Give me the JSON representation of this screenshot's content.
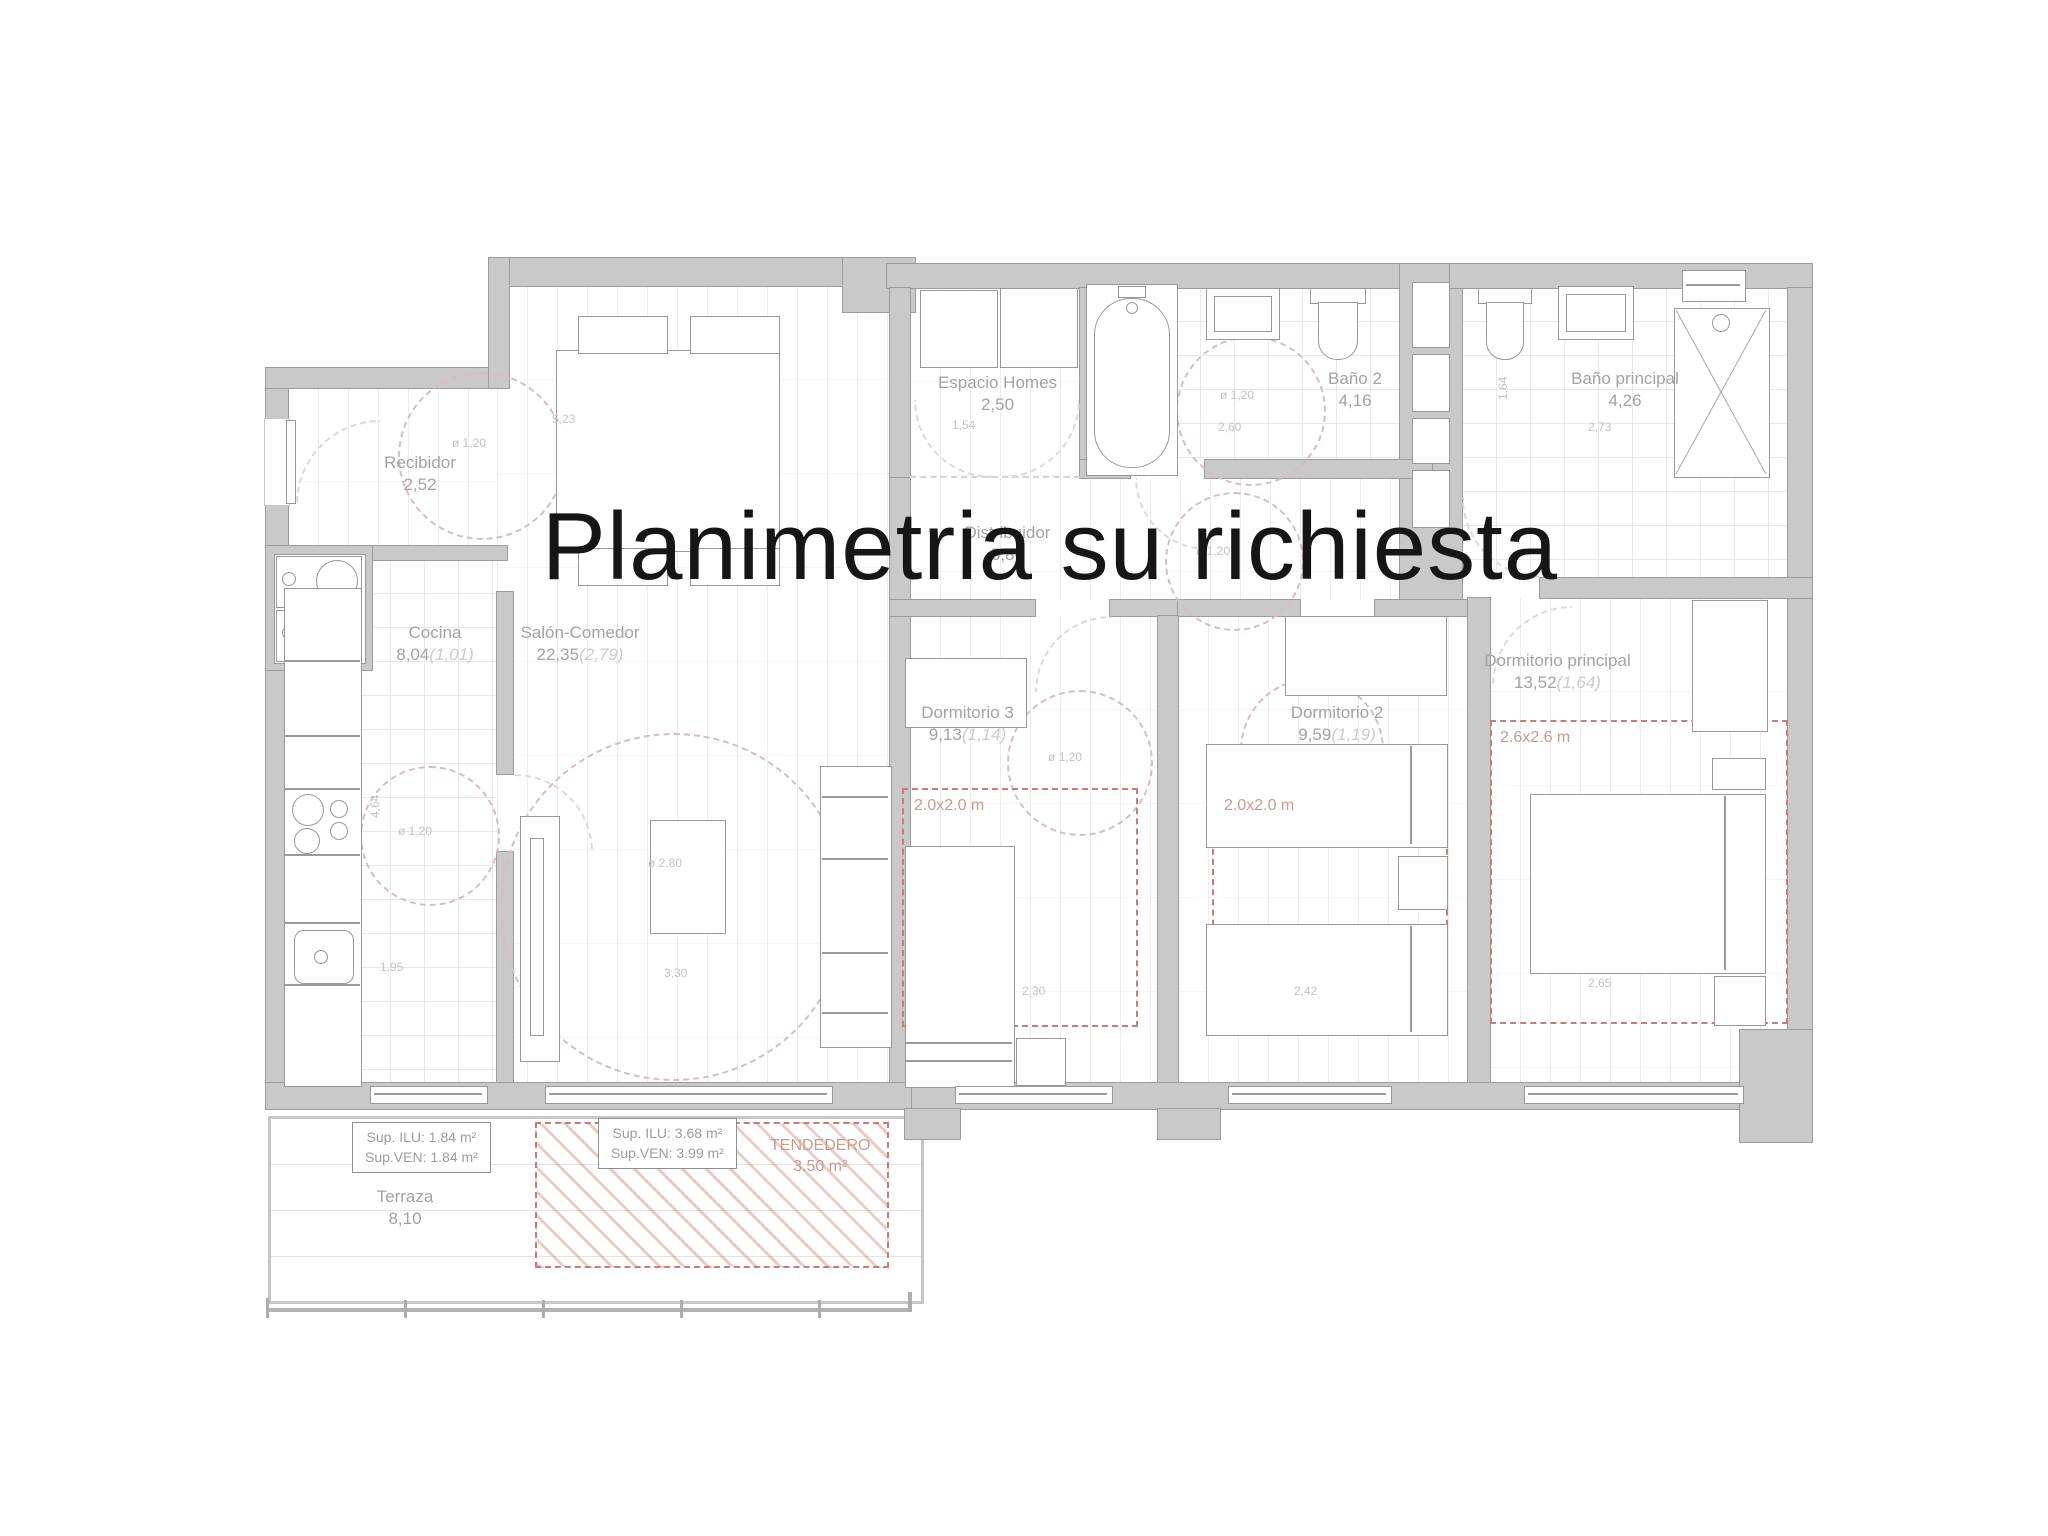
{
  "title": "Planimetria su richiesta",
  "rooms": {
    "recibidor": {
      "name": "Recibidor",
      "area": "2,52"
    },
    "cocina": {
      "name": "Cocina",
      "area": "8,04",
      "vent": "(1,01)"
    },
    "salon": {
      "name": "Salón-Comedor",
      "area": "22,35",
      "vent": "(2,79)"
    },
    "espacio_homes": {
      "name": "Espacio Homes",
      "area": "2,50"
    },
    "bano2": {
      "name": "Baño 2",
      "area": "4,16"
    },
    "bano_principal": {
      "name": "Baño principal",
      "area": "4,26"
    },
    "distribuidor": {
      "name": "Distribuidor",
      "area": "5,86"
    },
    "dormitorio3": {
      "name": "Dormitorio 3",
      "area": "9,13",
      "vent": "(1,14)"
    },
    "dormitorio2": {
      "name": "Dormitorio 2",
      "area": "9,59",
      "vent": "(1,19)"
    },
    "dormitorio_principal": {
      "name": "Dormitorio principal",
      "area": "13,52",
      "vent": "(1,64)"
    },
    "terraza": {
      "name": "Terraza",
      "area": "8,10"
    }
  },
  "annotations": {
    "sup_boxes": [
      {
        "ilu": "Sup. ILU:  1.84 m²",
        "ven": "Sup.VEN:  1.84 m²"
      },
      {
        "ilu": "Sup. ILU:  3.68 m²",
        "ven": "Sup.VEN:  3.99 m²"
      }
    ],
    "tendedero": {
      "name": "TENDEDERO",
      "area": "3.50 m²"
    },
    "clearance_squares": {
      "dorm3": "2.0x2.0 m",
      "dorm2": "2.0x2.0 m",
      "dormp": "2.6x2.6 m"
    }
  },
  "dimensions": {
    "salon_width": "5,23",
    "salon_circle": "ø 2,80",
    "salon_window": "3,30",
    "recibidor_circle": "ø 1,20",
    "cocina_circle": "ø 1,20",
    "cocina_depth": "4,64",
    "cocina_window": "1,95",
    "espacio_width": "1,54",
    "bano2_circle": "ø 1,20",
    "bano2_width": "2,60",
    "banop_depth": "1,64",
    "banop_width": "2,73",
    "distribuidor_circle": "ø 1,20",
    "dorm3_circle": "ø 1,20",
    "dorm3_width": "2,30",
    "dorm2_width": "2,42",
    "dormp_width": "2,65"
  },
  "colors": {
    "wall": "#c9c9c9",
    "label": "#a3a3a3",
    "red_accent": "#cd7b72",
    "title": "#161616"
  }
}
